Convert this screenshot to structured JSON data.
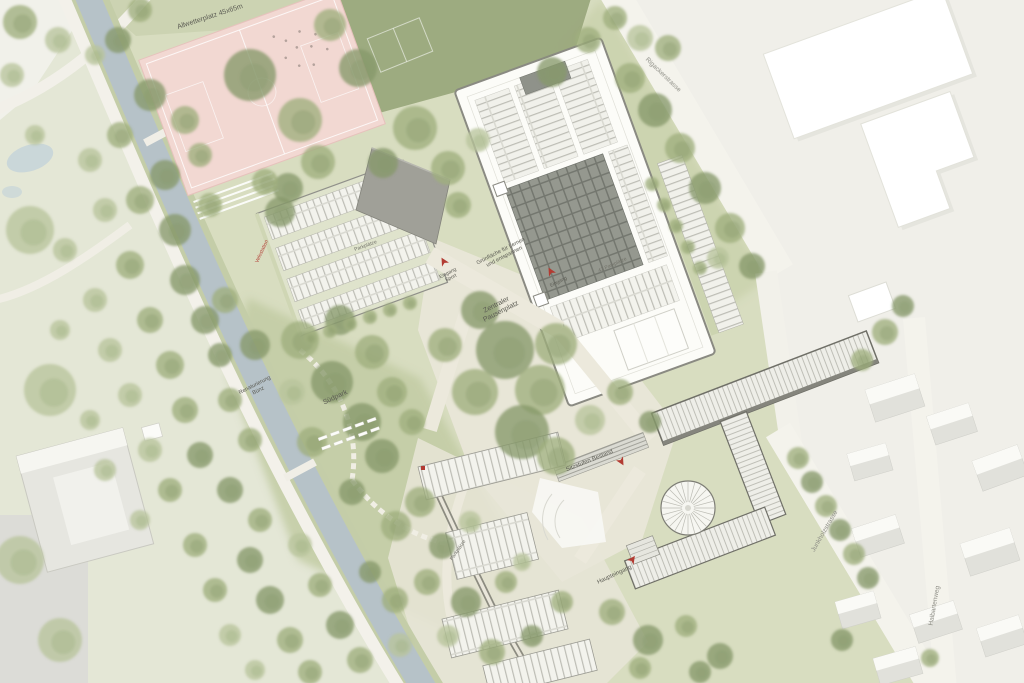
{
  "plan": {
    "labels": {
      "allwetterplatz": "Allwetterplatz 45x65m",
      "gruenflaeche_line1": "Grünfläche für Lernen",
      "gruenflaeche_line2": "und entspannen",
      "pausenplatz_line1": "Zentraler",
      "pausenplatz_line2": "Pausenplatz",
      "eingang_sport_line1": "Eingang",
      "eingang_sport_line2": "Sport",
      "eingang": "Eingang",
      "suedpark": "Südpark",
      "renaturierung_line1": "Renaturierung",
      "renaturierung_line2": "Bünz",
      "sitzstufen": "Sitzstufen Bestand",
      "haupteingang": "Haupteingang",
      "parkplaetze_42": "42 Parkplätze",
      "parkplaetze_west": "Parkplätze",
      "parkplaetze_sued": "Parkplätze",
      "velostation": "Velostation"
    },
    "streets": {
      "rigackerstrasse": "Rigackerstrasse",
      "junkholzstrasse": "Junkholzstrasse",
      "halbartenweg": "Halbartenweg"
    },
    "colors": {
      "water": "#b6c2c8",
      "pink_field": "#f2d8d2",
      "lawn": "#9aa87c",
      "park_green": "#d8ddc0",
      "plaza": "#e9e6d8",
      "tree_light": "#b9c49c",
      "tree_mid": "#9fae7e",
      "tree_dark": "#87986a",
      "accent_red": "#b23b32"
    }
  }
}
